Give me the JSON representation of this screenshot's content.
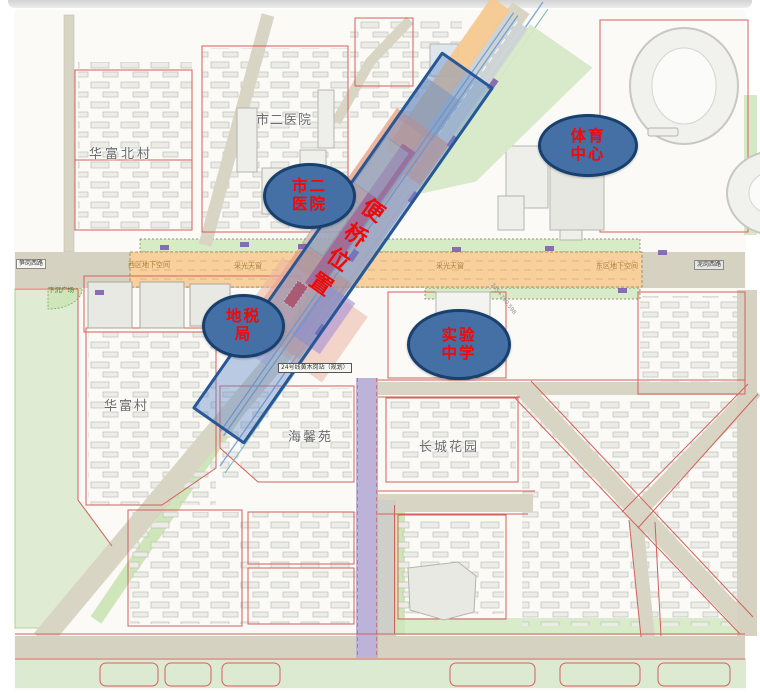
{
  "map": {
    "bridge_band": {
      "label": "便桥位置"
    },
    "callouts": [
      {
        "name": "city-second-hospital",
        "line1": "市二",
        "line2": "医院"
      },
      {
        "name": "sports-center",
        "line1": "体育",
        "line2": "中心"
      },
      {
        "name": "local-tax-bureau",
        "line1": "地税",
        "line2": "局"
      },
      {
        "name": "experimental-school",
        "line1": "实验",
        "line2": "中学"
      }
    ],
    "district_labels": [
      {
        "name": "city-second-hospital-area",
        "text": "市二医院"
      },
      {
        "name": "huafu-north-village",
        "text": "华富北村"
      },
      {
        "name": "huafu-village",
        "text": "华富村"
      },
      {
        "name": "haixin-garden",
        "text": "海馨苑"
      },
      {
        "name": "greatwall-garden",
        "text": "长城花园"
      }
    ],
    "road_labels": [
      {
        "name": "sungang-west-road",
        "text": "笋岗西路"
      },
      {
        "name": "west-underground-space",
        "text": "西区地下空间"
      },
      {
        "name": "skylight-west",
        "text": "采光天窗"
      },
      {
        "name": "skylight-east",
        "text": "采光天窗"
      },
      {
        "name": "east-underground-space",
        "text": "东区地下空间"
      },
      {
        "name": "nigang-west-road",
        "text": "泥岗西路"
      },
      {
        "name": "sunken-plaza",
        "text": "下沉广场"
      },
      {
        "name": "metro-station",
        "text": "24号线黄木岗站（规划）"
      }
    ],
    "survey_marks": [
      {
        "text": "745+780.598"
      },
      {
        "text": "735.647"
      }
    ],
    "colors": {
      "callout_fill": "#4470a6",
      "callout_border": "#17406e",
      "callout_text": "#fa0505",
      "band_fill": "rgba(96,136,197,0.42)",
      "band_border": "#275796",
      "band_text": "#ef0a0a",
      "road_orange": "#f9cf9c",
      "road_beige": "#d9d5c4",
      "road_purple": "#bdb2d8",
      "parcel_red": "#d4605a",
      "green": "#dfecd3",
      "salmon": "#e89c80"
    }
  }
}
